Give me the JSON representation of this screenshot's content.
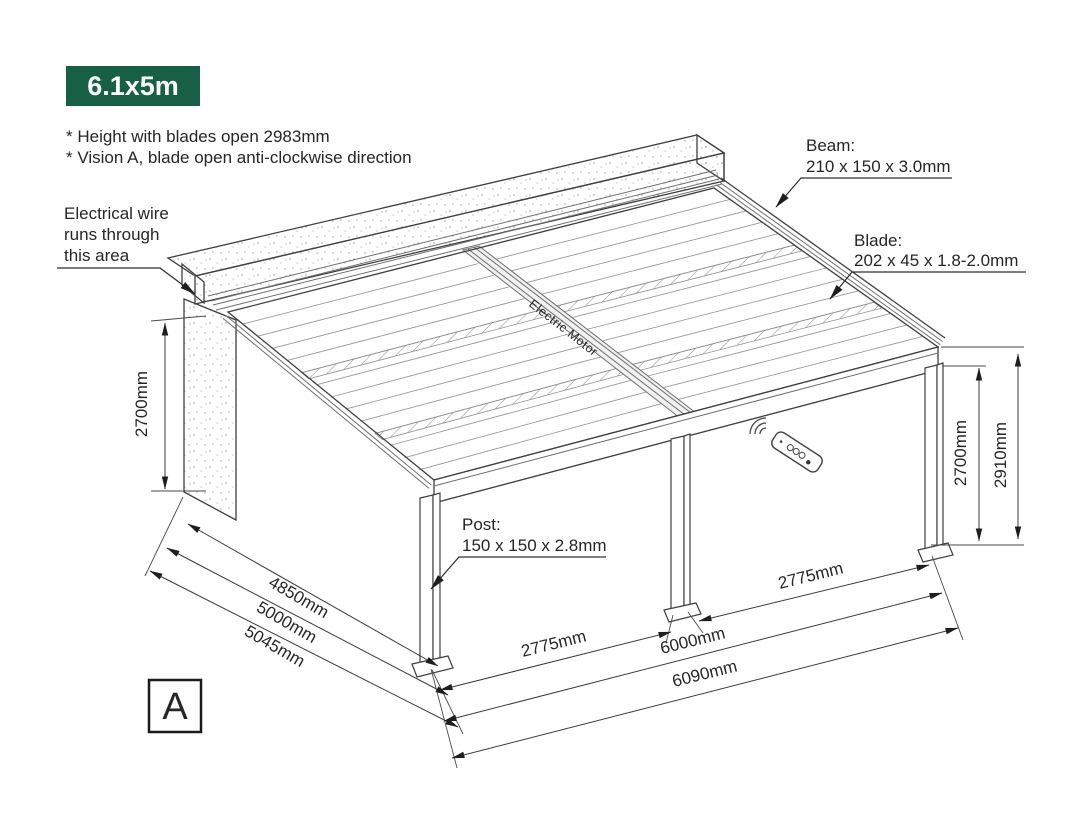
{
  "badge": {
    "label": "6.1x5m"
  },
  "notes": {
    "line1": "* Height with blades open 2983mm",
    "line2": "* Vision A, blade open anti-clockwise direction"
  },
  "annotations": {
    "electrical": {
      "line1": "Electrical wire",
      "line2": "runs through",
      "line3": "this area"
    },
    "beam": {
      "title": "Beam:",
      "spec": "210 x 150 x 3.0mm"
    },
    "blade": {
      "title": "Blade:",
      "spec": "202 x 45 x 1.8-2.0mm"
    },
    "post": {
      "title": "Post:",
      "spec": "150 x 150 x 2.8mm"
    },
    "motor": {
      "label": "Electric Motor"
    }
  },
  "dimensions": {
    "wall_height": "2700mm",
    "depth_blades": "4850mm",
    "depth_frame": "5000mm",
    "depth_overall": "5045mm",
    "front_bay_left": "2775mm",
    "front_bay_right": "2775mm",
    "front_frame": "6000mm",
    "front_overall": "6090mm",
    "post_height": "2700mm",
    "overall_height": "2910mm"
  },
  "view": {
    "label": "A"
  },
  "colors": {
    "badge_green": "#176045",
    "line": "#3f3f3f"
  }
}
